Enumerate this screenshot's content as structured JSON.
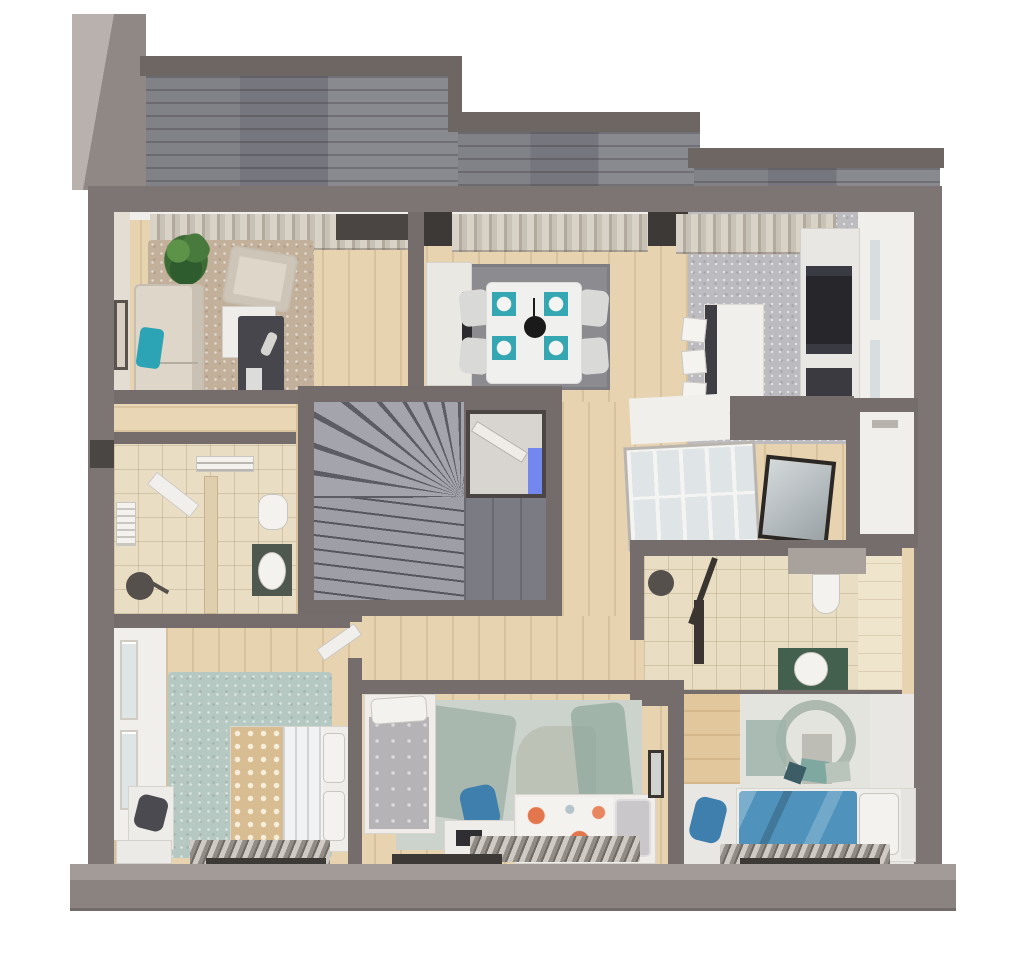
{
  "scene": {
    "type": "3d-floor-plan-render",
    "view": "top-down dollhouse cutaway of one apartment storey",
    "background_color": "#ffffff",
    "rooms": [
      {
        "name": "roof terrace",
        "features": [
          "paved grey roof deck",
          "stepped parapet walls",
          "corner parapet tower"
        ]
      },
      {
        "name": "living room",
        "furniture": [
          "cream three-seat sofa",
          "teal accent cushion",
          "dark coffee table with remote and magazines",
          "white side table",
          "cream armchair",
          "potted green plant",
          "beige area rug",
          "framed wall art",
          "window curtains"
        ]
      },
      {
        "name": "dining area",
        "furniture": [
          "white dining table",
          "four upholstered chairs",
          "four teal place settings with white plates",
          "black pendant lamp",
          "dark grey rug",
          "white desk with dark monitor"
        ]
      },
      {
        "name": "kitchen",
        "furniture": [
          "white island with dark base",
          "three bar stools",
          "tall cabinet wall with built-in dark oven column",
          "second dark appliance front",
          "terrazzo grey floor",
          "window curtains"
        ]
      },
      {
        "name": "stair hall",
        "furniture": [
          "winder staircase with grey treads",
          "lower straight flight",
          "tiled landing",
          "entry door with bright blue glazed sidelight"
        ]
      },
      {
        "name": "hallway",
        "furniture": [
          "light wood flooring",
          "open white door to master bedroom"
        ]
      },
      {
        "name": "shower room",
        "furniture": [
          "walk-in shower with round dark rain head",
          "oval washbasin on dark green stand",
          "toilet",
          "towel rail",
          "wall radiator",
          "open white door",
          "beige floor tiles"
        ]
      },
      {
        "name": "glazed corridor",
        "furniture": [
          "sloped glazed partition grid",
          "leaning dark-framed mirror",
          "white shelf band"
        ]
      },
      {
        "name": "storage room",
        "features": [
          "empty white room",
          "small wall vent"
        ]
      },
      {
        "name": "second bathroom",
        "furniture": [
          "walk-in shower with round dark head",
          "dark shower screen",
          "wall-hung toilet with shelf over",
          "round basin on green stone vanity",
          "beige wall tiles"
        ]
      },
      {
        "name": "master bedroom",
        "furniture": [
          "double bed with dotted beige cover and white duvet",
          "two white pillows",
          "pale blue-green rug",
          "french-window wardrobe wall",
          "white desk with dark chair",
          "drawer units",
          "radiator under front window"
        ]
      },
      {
        "name": "kids bedroom",
        "furniture": [
          "single bed with grey blanket",
          "white desk with dark laptop",
          "blue desk chair",
          "bed with white and orange floral bedding",
          "grey pillow",
          "abstract grey-green rug",
          "framed art on wall",
          "radiator under front window"
        ]
      },
      {
        "name": "third bedroom",
        "furniture": [
          "double bed with blue duvet",
          "white and grey pillows",
          "teal accent cushions",
          "abstract arc wall mural",
          "wood accent strip",
          "blue chair",
          "radiator under front window"
        ]
      }
    ],
    "palette": {
      "outer_wall": "#7d7573",
      "partition_wall": "#756d6b",
      "roof_tile": "#76767e",
      "roof_band": "#6e6663",
      "parapet_light": "#b8b1ae",
      "white_wall_face": "#f1efec",
      "wood_floor": "#e7d3b0",
      "beige_tile": "#e9dec3",
      "living_rug": "#c2b09a",
      "dining_rug": "#8b8b90",
      "master_rug": "#b6c8c2",
      "kids_rug": "#ccd3cd",
      "teal_accent": "#2da4b5",
      "vanity_green": "#43604f",
      "blue_bed": "#4f93bc",
      "blue_chair": "#3e7fae",
      "orange_floral": "#e4764d",
      "plant_green": "#477a3c",
      "door_glass_blue": "#7387ef",
      "coffee_table_dark": "#46464c",
      "appliance_dark": "#26262b",
      "front_wall_face": "#8b8380"
    }
  }
}
